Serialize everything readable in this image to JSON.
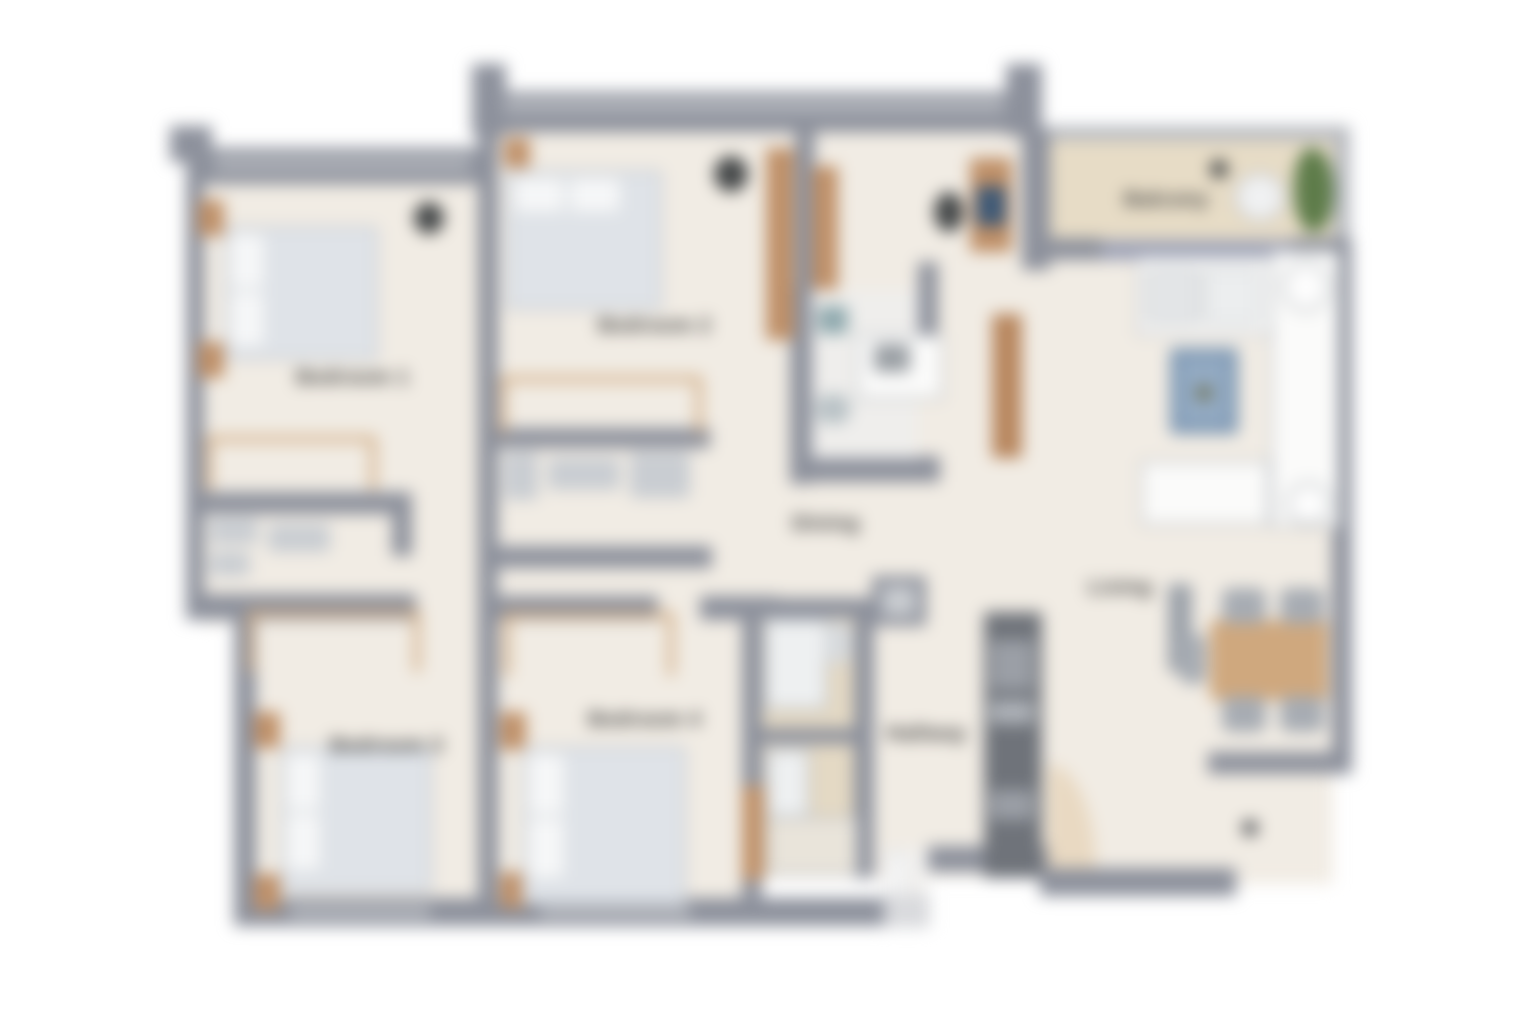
{
  "title": "Blurred apartment floor plan",
  "rooms": {
    "bedroom1": {
      "label": "Bedroom 1"
    },
    "bedroom2": {
      "label": "Bedroom 2"
    },
    "bedroom3": {
      "label": "Bedroom 3"
    },
    "bedroom4": {
      "label": "Bedroom 4"
    },
    "dining": {
      "label": "Dining"
    },
    "living": {
      "label": "Living"
    },
    "hallway": {
      "label": "Hallway"
    },
    "balcony": {
      "label": "Balcony"
    }
  },
  "colors": {
    "background": "#ffffff",
    "floor": "#f1ece4",
    "balcony_floor": "#e7dcc6",
    "bath_floor": "#e4d9c4",
    "wall": "#8d919c",
    "wall_light": "#b6b9bf",
    "slider": "#9ea3b7",
    "wood": "#bf9068",
    "wood_light": "#cfa87e",
    "bed": "#dfe3e8",
    "pillow": "#f6f7f8",
    "island": "#7e98b4",
    "island_inner": "#93aac2",
    "plant": "#5e7c4a",
    "appliance": "#6f737a",
    "counter": "#fbfbfa",
    "counter_border": "#c2c5c9",
    "dark_accent": "#46494a",
    "label": "#454545"
  }
}
